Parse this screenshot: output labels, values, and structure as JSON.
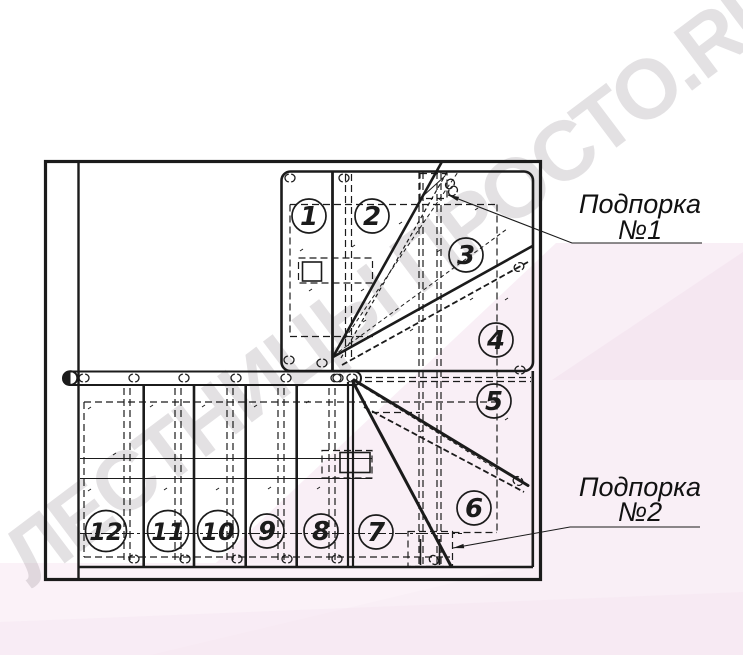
{
  "watermark": {
    "text": "ЛЕСТНИЦЫ ПРОСТО.RU"
  },
  "drawing": {
    "type": "staircase-plan",
    "steps": [
      {
        "n": "1",
        "cx": 309,
        "cy": 216
      },
      {
        "n": "2",
        "cx": 372,
        "cy": 216
      },
      {
        "n": "3",
        "cx": 466,
        "cy": 255
      },
      {
        "n": "4",
        "cx": 496,
        "cy": 340
      },
      {
        "n": "5",
        "cx": 494,
        "cy": 401
      },
      {
        "n": "6",
        "cx": 474,
        "cy": 508
      },
      {
        "n": "7",
        "cx": 376,
        "cy": 532
      },
      {
        "n": "8",
        "cx": 321,
        "cy": 531
      },
      {
        "n": "9",
        "cx": 267,
        "cy": 531
      },
      {
        "n": "10",
        "cx": 218,
        "cy": 531
      },
      {
        "n": "11",
        "cx": 168,
        "cy": 531
      },
      {
        "n": "12",
        "cx": 106,
        "cy": 531
      }
    ],
    "supports": [
      {
        "id": "support-1",
        "line1": "Подпорка",
        "line2": "№1",
        "tx": 640,
        "ty1": 213,
        "ty2": 239,
        "ux1": 572,
        "ux2": 702,
        "uy": 243,
        "ax": 448,
        "ay": 195
      },
      {
        "id": "support-2",
        "line1": "Подпорка",
        "line2": "№2",
        "tx": 640,
        "ty1": 496,
        "ty2": 521,
        "ux1": 570,
        "ux2": 700,
        "uy": 527,
        "ax": 453,
        "ay": 548
      }
    ]
  },
  "style": {
    "line_color": "#1b1b1b",
    "pink_accent": "#f9eff6",
    "watermark_color": "rgba(128,118,128,0.22)"
  }
}
